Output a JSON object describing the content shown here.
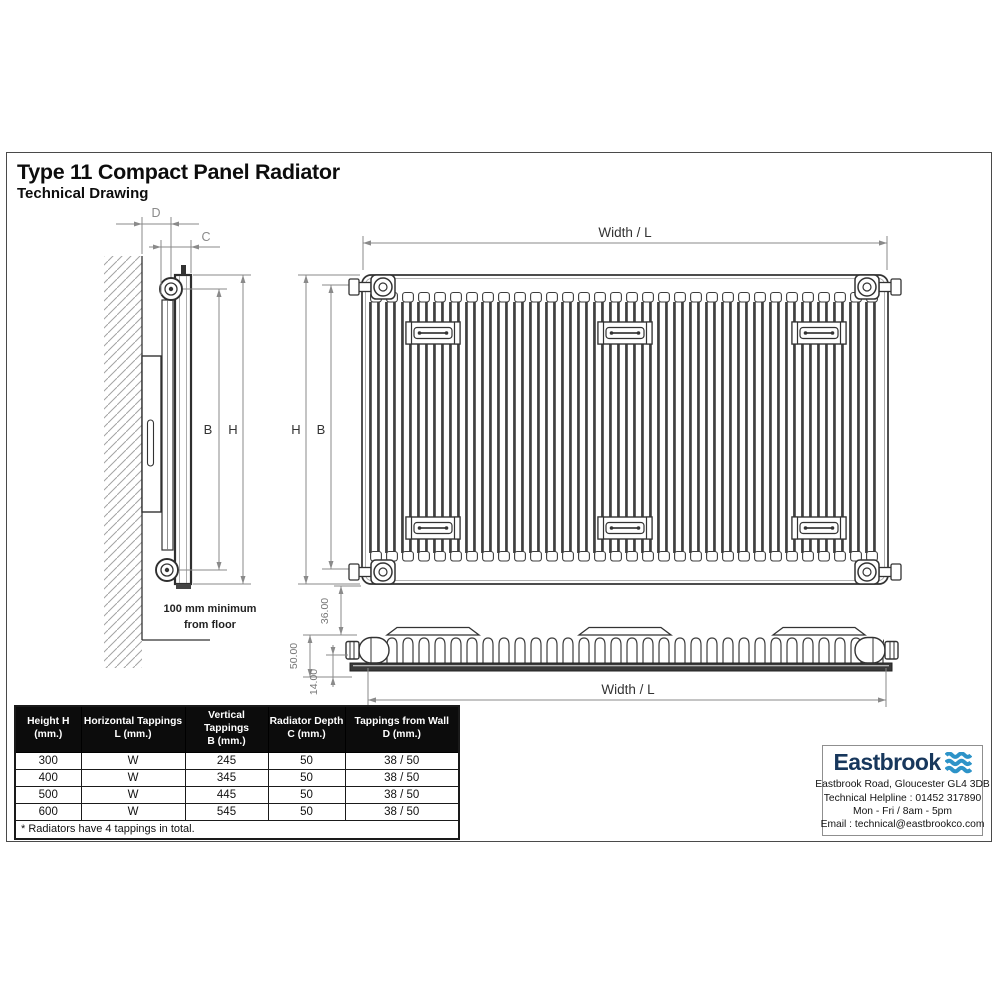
{
  "title": "Type 11 Compact Panel Radiator",
  "subtitle": "Technical Drawing",
  "drawing": {
    "dim_d_label": "D",
    "dim_c_label": "C",
    "side_dim_b_label": "B",
    "side_dim_h_label": "H",
    "front_dim_h_label": "H",
    "front_dim_b_label": "B",
    "front_width_label": "Width / L",
    "plan_width_label": "Width / L",
    "plan_depth_36": "36.00",
    "plan_depth_50": "50.00",
    "plan_depth_14": "14.00",
    "floor_note_line1": "100 mm minimum",
    "floor_note_line2": "from floor"
  },
  "table": {
    "headers": [
      {
        "line1": "Height H",
        "line2": "(mm.)"
      },
      {
        "line1": "Horizontal Tappings",
        "line2": "L (mm.)"
      },
      {
        "line1": "Vertical Tappings",
        "line2": "B (mm.)"
      },
      {
        "line1": "Radiator Depth",
        "line2": "C (mm.)"
      },
      {
        "line1": "Tappings from Wall",
        "line2": "D (mm.)"
      }
    ],
    "rows": [
      [
        "300",
        "W",
        "245",
        "50",
        "38 / 50"
      ],
      [
        "400",
        "W",
        "345",
        "50",
        "38 / 50"
      ],
      [
        "500",
        "W",
        "445",
        "50",
        "38 / 50"
      ],
      [
        "600",
        "W",
        "545",
        "50",
        "38 / 50"
      ]
    ],
    "footnote": "* Radiators have 4 tappings in total."
  },
  "logo": {
    "brand": "Eastbrook",
    "address": "Eastbrook Road, Gloucester GL4 3DB",
    "helpline": "Technical Helpline : 01452 317890",
    "hours": "Mon - Fri / 8am - 5pm",
    "email": "Email : technical@eastbrookco.com",
    "colors": {
      "brand_navy": "#17375c",
      "wave_blue": "#2d93c8"
    }
  }
}
